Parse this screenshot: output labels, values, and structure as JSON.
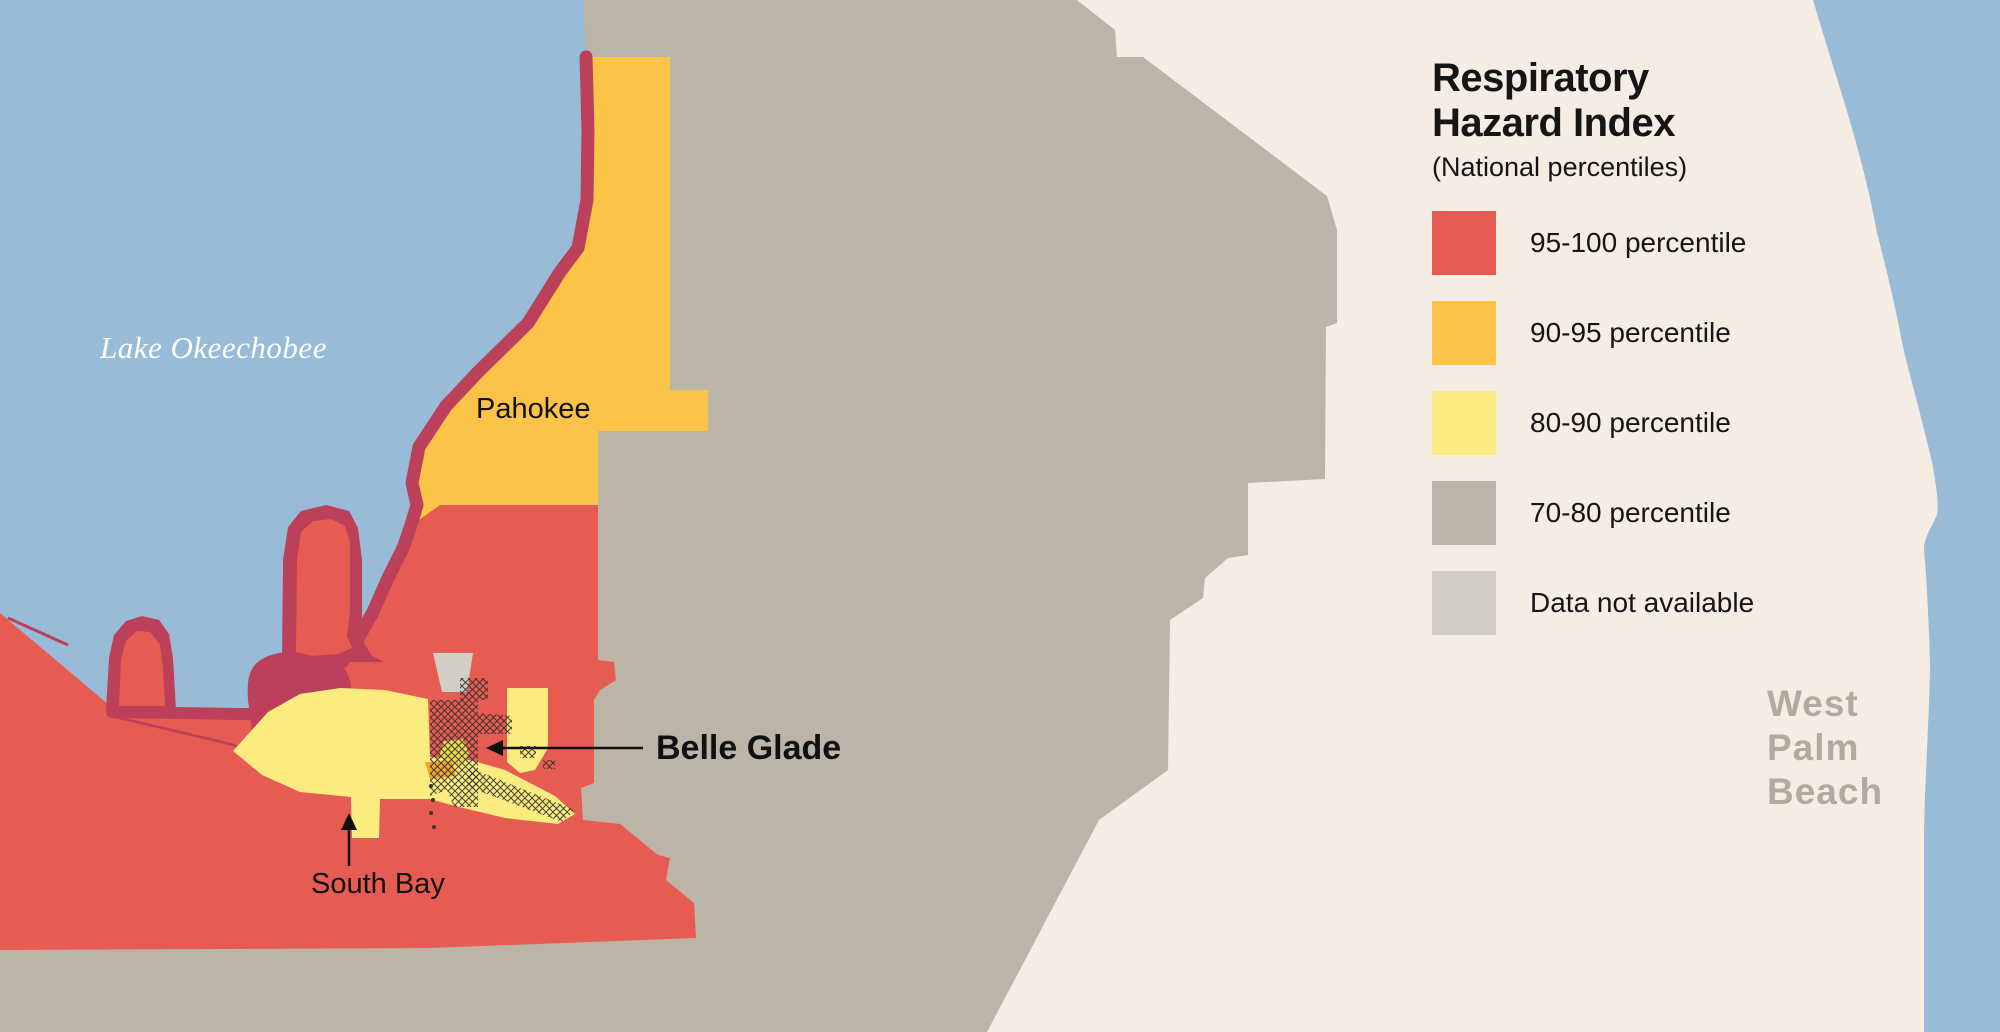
{
  "title": {
    "line1": "Respiratory",
    "line2": "Hazard Index",
    "subtitle": "(National percentiles)"
  },
  "legend": {
    "items": [
      {
        "label": "95-100 percentile",
        "color": "#E65C53"
      },
      {
        "label": "90-95 percentile",
        "color": "#FBC449"
      },
      {
        "label": "80-90 percentile",
        "color": "#FAEC7F"
      },
      {
        "label": "70-80 percentile",
        "color": "#BCB4A7"
      },
      {
        "label": "Data not available",
        "color": "#D2CEC5"
      }
    ]
  },
  "map_labels": {
    "lake": "Lake Okeechobee",
    "pahokee": "Pahokee",
    "belle_glade": "Belle Glade",
    "south_bay": "South Bay",
    "west_palm_beach": [
      "West",
      "Palm",
      "Beach"
    ]
  },
  "colors": {
    "water": "#98BCD8",
    "cream": "#F5EDE4",
    "gray_70_80": "#BCB4A7",
    "gray_na": "#D2CEC5",
    "red": "#E65C53",
    "orange": "#FBC449",
    "yellow": "#FAEC7F",
    "maroon": "#BC4059",
    "hatch_yellow": "#F0D94A",
    "hatch_orange": "#F2A430",
    "hatch_line": "#2E2E2E",
    "arrow": "#111111"
  }
}
